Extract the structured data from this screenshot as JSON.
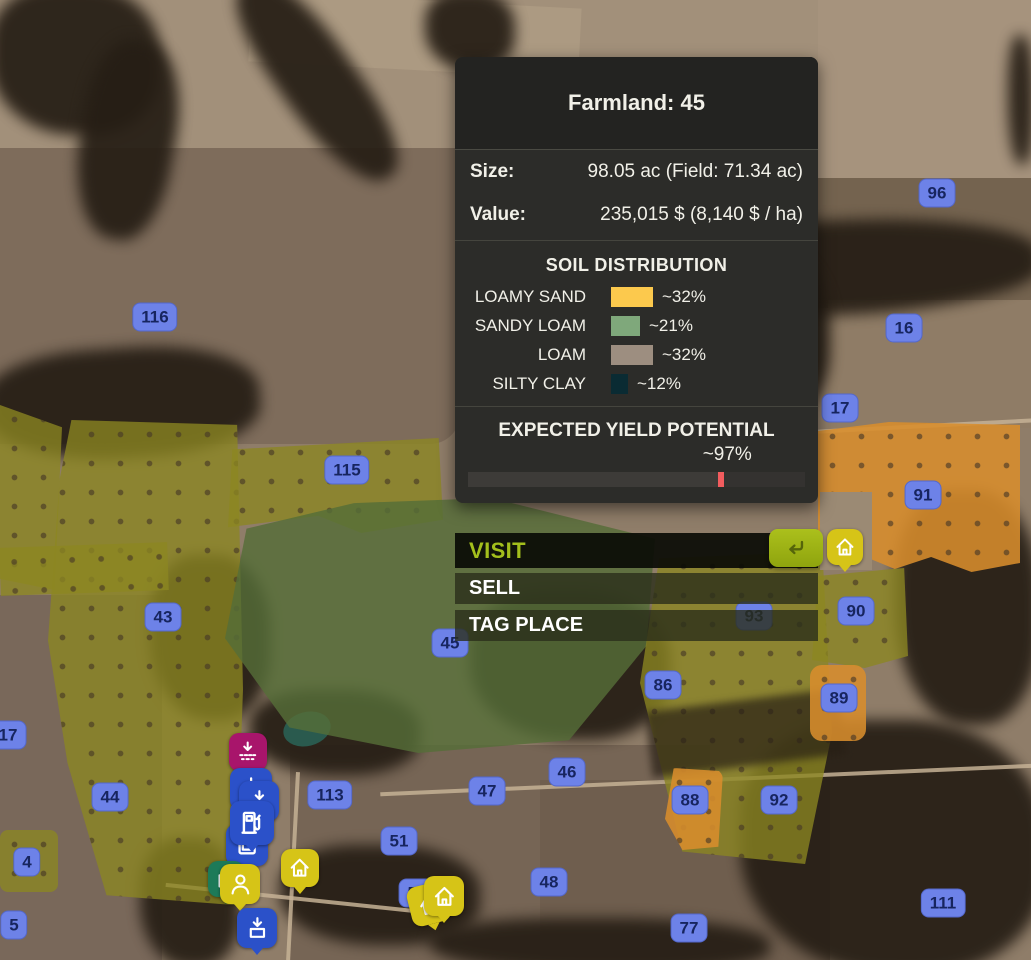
{
  "panel": {
    "title": "Farmland: 45",
    "size_label": "Size:",
    "size_value": "98.05 ac (Field: 71.34 ac)",
    "value_label": "Value:",
    "value_value": "235,015 $ (8,140 $ / ha)",
    "soil": {
      "title": "SOIL DISTRIBUTION",
      "rows": [
        {
          "label": "LOAMY SAND",
          "pct": "~32%",
          "color": "#fcc94d",
          "swatch_width": 42
        },
        {
          "label": "SANDY LOAM",
          "pct": "~21%",
          "color": "#7fa87b",
          "swatch_width": 29
        },
        {
          "label": "LOAM",
          "pct": "~32%",
          "color": "#9d8e80",
          "swatch_width": 42
        },
        {
          "label": "SILTY CLAY",
          "pct": "~12%",
          "color": "#0a2b33",
          "swatch_width": 17
        }
      ]
    },
    "yield": {
      "title": "EXPECTED YIELD POTENTIAL",
      "value": "~97%",
      "marker_pos_pct": 75,
      "marker_color": "#f25c5e"
    }
  },
  "actions": {
    "visit": "VISIT",
    "sell": "SELL",
    "tag_place": "TAG PLACE"
  },
  "map": {
    "field_labels": [
      {
        "num": "116",
        "x": 155,
        "y": 317
      },
      {
        "num": "96",
        "x": 937,
        "y": 193
      },
      {
        "num": "16",
        "x": 904,
        "y": 328
      },
      {
        "num": "17",
        "x": 840,
        "y": 408
      },
      {
        "num": "115",
        "x": 347,
        "y": 470
      },
      {
        "num": "91",
        "x": 923,
        "y": 495
      },
      {
        "num": "43",
        "x": 163,
        "y": 617
      },
      {
        "num": "90",
        "x": 856,
        "y": 611
      },
      {
        "num": "93",
        "x": 754,
        "y": 616
      },
      {
        "num": "45",
        "x": 450,
        "y": 643
      },
      {
        "num": "86",
        "x": 663,
        "y": 685
      },
      {
        "num": "89",
        "x": 839,
        "y": 698
      },
      {
        "num": "17",
        "x": 8,
        "y": 735
      },
      {
        "num": "46",
        "x": 567,
        "y": 772
      },
      {
        "num": "47",
        "x": 487,
        "y": 791
      },
      {
        "num": "44",
        "x": 110,
        "y": 797
      },
      {
        "num": "113",
        "x": 330,
        "y": 795
      },
      {
        "num": "92",
        "x": 779,
        "y": 800
      },
      {
        "num": "88",
        "x": 690,
        "y": 800
      },
      {
        "num": "51",
        "x": 399,
        "y": 841
      },
      {
        "num": "4",
        "x": 27,
        "y": 862
      },
      {
        "num": "48",
        "x": 549,
        "y": 882
      },
      {
        "num": "50",
        "x": 417,
        "y": 893
      },
      {
        "num": "111",
        "x": 943,
        "y": 903
      },
      {
        "num": "77",
        "x": 689,
        "y": 928
      },
      {
        "num": "5",
        "x": 14,
        "y": 925
      }
    ],
    "markers": [
      {
        "icon": "unload-pallet-icon",
        "color": "#a8156b",
        "x": 248,
        "y": 752,
        "size": 38
      },
      {
        "icon": "unload-trailer-icon",
        "color": "#2b51c9",
        "x": 251,
        "y": 789,
        "size": 42
      },
      {
        "icon": "unload-trailer-icon",
        "color": "#2b51c9",
        "x": 259,
        "y": 801,
        "size": 40
      },
      {
        "icon": "storage-box-icon",
        "color": "#2b51c9",
        "x": 247,
        "y": 845,
        "size": 42
      },
      {
        "icon": "fuel-station-icon",
        "color": "#2b51c9",
        "x": 252,
        "y": 823,
        "size": 44
      },
      {
        "icon": "house-icon",
        "color": "#d6c417",
        "x": 300,
        "y": 868,
        "size": 38
      },
      {
        "icon": "shop-icon",
        "color": "#1d7a58",
        "x": 226,
        "y": 879,
        "size": 36
      },
      {
        "icon": "player-icon",
        "color": "#d6c417",
        "x": 240,
        "y": 884,
        "size": 40
      },
      {
        "icon": "unload-box-icon",
        "color": "#2b51c9",
        "x": 257,
        "y": 928,
        "size": 40
      },
      {
        "icon": "house-icon",
        "color": "#d6c417",
        "x": 429,
        "y": 904,
        "size": 40,
        "rot": -14
      },
      {
        "icon": "house-icon",
        "color": "#d6c417",
        "x": 444,
        "y": 896,
        "size": 40
      },
      {
        "icon": "house-icon",
        "color": "#d6c417",
        "x": 845,
        "y": 547,
        "size": 36
      }
    ]
  }
}
